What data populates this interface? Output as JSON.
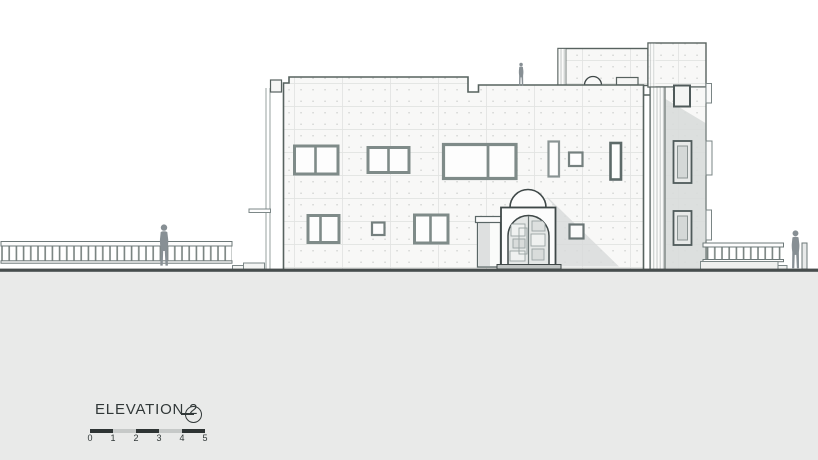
{
  "label": {
    "title": "ELEVATION 2"
  },
  "scale_bar": {
    "ticks": [
      "0",
      "1",
      "2",
      "3",
      "4",
      "5"
    ],
    "segment_colors": [
      "#2e3434",
      "#c6c9c8",
      "#2e3434",
      "#c6c9c8",
      "#2e3434"
    ]
  },
  "icons": {
    "orientation_marker": "circle-dash-icon"
  },
  "colors": {
    "paper": "#ffffff",
    "ground_fill": "#e9eae9",
    "ground_line": "#474d4d",
    "outline": "#57625f",
    "window_frame": "#7f8b89",
    "shadow": "#d8dbda",
    "figure": "#878f94",
    "facade_fill": "#f8f8f7",
    "tower_fill": "#ededec",
    "label_text": "#313838",
    "scale_dark": "#2e3434",
    "scale_light": "#c6c9c8"
  }
}
